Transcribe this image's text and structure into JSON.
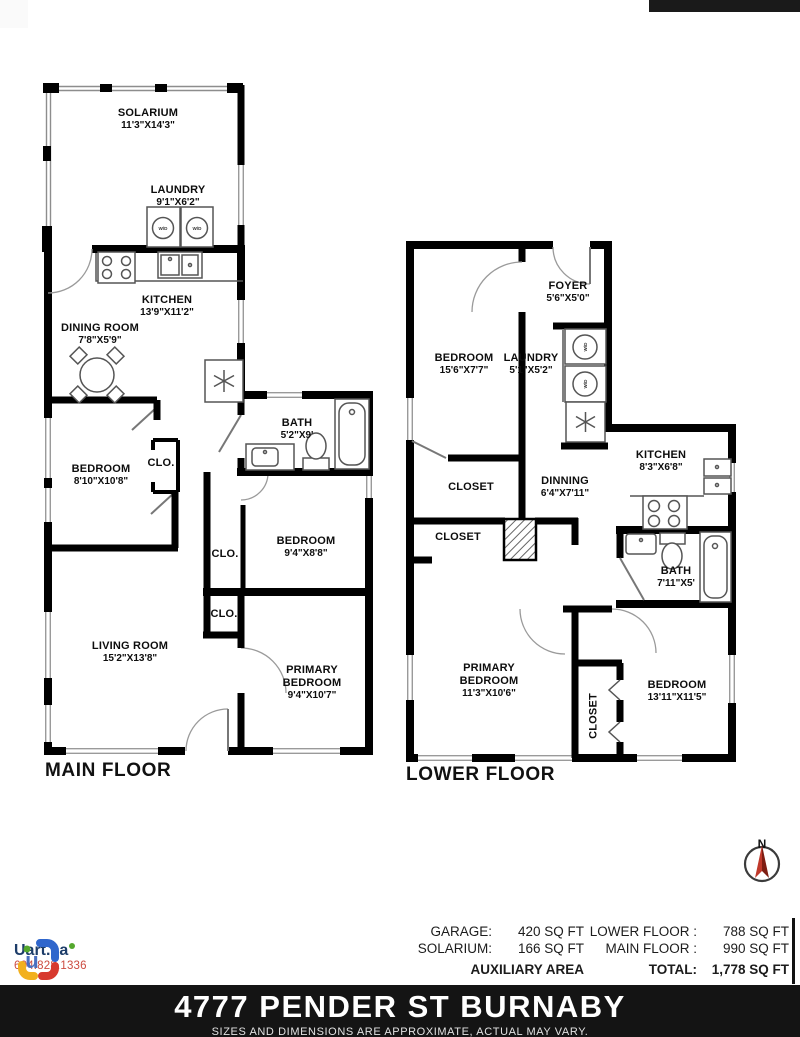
{
  "main_floor": {
    "title": "MAIN FLOOR",
    "rooms": [
      {
        "name": "SOLARIUM",
        "dims": "11'3\"X14'3\""
      },
      {
        "name": "LAUNDRY",
        "dims": "9'1\"X6'2\""
      },
      {
        "name": "KITCHEN",
        "dims": "13'9\"X11'2\""
      },
      {
        "name": "DINING ROOM",
        "dims": "7'8\"X5'9\""
      },
      {
        "name": "BEDROOM",
        "dims": "8'10\"X10'8\""
      },
      {
        "name": "CLO.",
        "dims": ""
      },
      {
        "name": "BATH",
        "dims": "5'2\"X9'"
      },
      {
        "name": "BEDROOM",
        "dims": "9'4\"X8'8\""
      },
      {
        "name": "CLO.",
        "dims": ""
      },
      {
        "name": "CLO.",
        "dims": ""
      },
      {
        "name": "LIVING ROOM",
        "dims": "15'2\"X13'8\""
      },
      {
        "name": "PRIMARY BEDROOM",
        "dims": "9'4\"X10'7\""
      }
    ]
  },
  "lower_floor": {
    "title": "LOWER FLOOR",
    "rooms": [
      {
        "name": "FOYER",
        "dims": "5'6\"X5'0\""
      },
      {
        "name": "BEDROOM",
        "dims": "15'6\"X7'7\""
      },
      {
        "name": "LAUNDRY",
        "dims": "5'1\"X5'2\""
      },
      {
        "name": "KITCHEN",
        "dims": "8'3\"X6'8\""
      },
      {
        "name": "CLOSET",
        "dims": ""
      },
      {
        "name": "DINNING",
        "dims": "6'4\"X7'11\""
      },
      {
        "name": "CLOSET",
        "dims": ""
      },
      {
        "name": "BATH",
        "dims": "7'11\"X5'"
      },
      {
        "name": "PRIMARY BEDROOM",
        "dims": "11'3\"X10'6\""
      },
      {
        "name": "CLOSET",
        "dims": ""
      },
      {
        "name": "BEDROOM",
        "dims": "13'11\"X11'5\""
      }
    ]
  },
  "labels": {
    "wd": "W/D"
  },
  "compass": {
    "label": "N"
  },
  "logo": {
    "brand": "Uart.ca",
    "phone": "604.828.1336"
  },
  "area_summary": {
    "auxiliary": [
      {
        "label": "GARAGE:",
        "value": "420 SQ FT"
      },
      {
        "label": "SOLARIUM:",
        "value": "166 SQ FT"
      }
    ],
    "auxiliary_title": "AUXILIARY AREA",
    "floors": [
      {
        "label": "LOWER FLOOR :",
        "value": "788 SQ FT"
      },
      {
        "label": "MAIN FLOOR :",
        "value": "990 SQ FT"
      }
    ],
    "total_label": "TOTAL:",
    "total_value": "1,778 SQ FT"
  },
  "address_bar": {
    "line": "4777 PENDER ST BURNABY",
    "disclaimer": "SIZES AND DIMENSIONS ARE APPROXIMATE, ACTUAL MAY VARY."
  },
  "colors": {
    "wall": "#000000",
    "footer_bg": "#141414",
    "brand_navy": "#1d3d69",
    "phone_red": "#cc4b40",
    "compass_red": "#b22a1d",
    "logo_blue": "#2f66cc",
    "logo_red": "#d7392e",
    "logo_yellow": "#f2b01e",
    "logo_green": "#54a82d"
  }
}
